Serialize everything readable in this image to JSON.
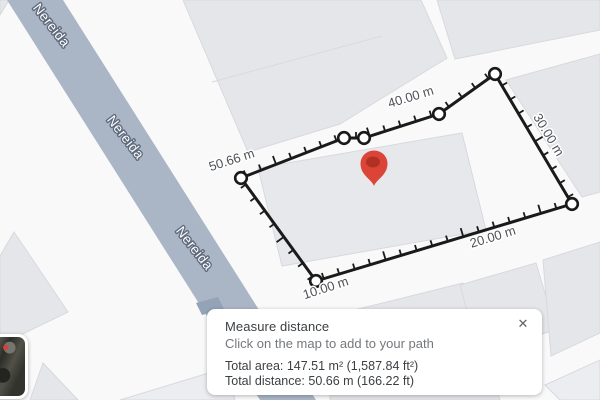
{
  "map": {
    "road_name": "Nereida",
    "road_labels": [
      "Nereida",
      "Nereida",
      "Nereida"
    ],
    "distance_markers": [
      "50.66 m",
      "40.00 m",
      "30.00 m",
      "20.00 m",
      "10.00 m"
    ],
    "pin": "red-map-pin"
  },
  "measure_panel": {
    "title": "Measure distance",
    "subtitle": "Click on the map to add to your path",
    "total_area": "Total area: 147.51 m² (1,587.84 ft²)",
    "total_distance": "Total distance: 50.66 m (166.22 ft)",
    "close_label": "✕"
  },
  "colors": {
    "road_fill": "#aab6c6",
    "road_dark_patch": "#93a3b8",
    "parcel_fill": "#e5e6ea",
    "path_black": "#1a1a1a",
    "pin_red": "#db4437",
    "pin_inner": "#b03124",
    "panel_bg": "#ffffff"
  }
}
